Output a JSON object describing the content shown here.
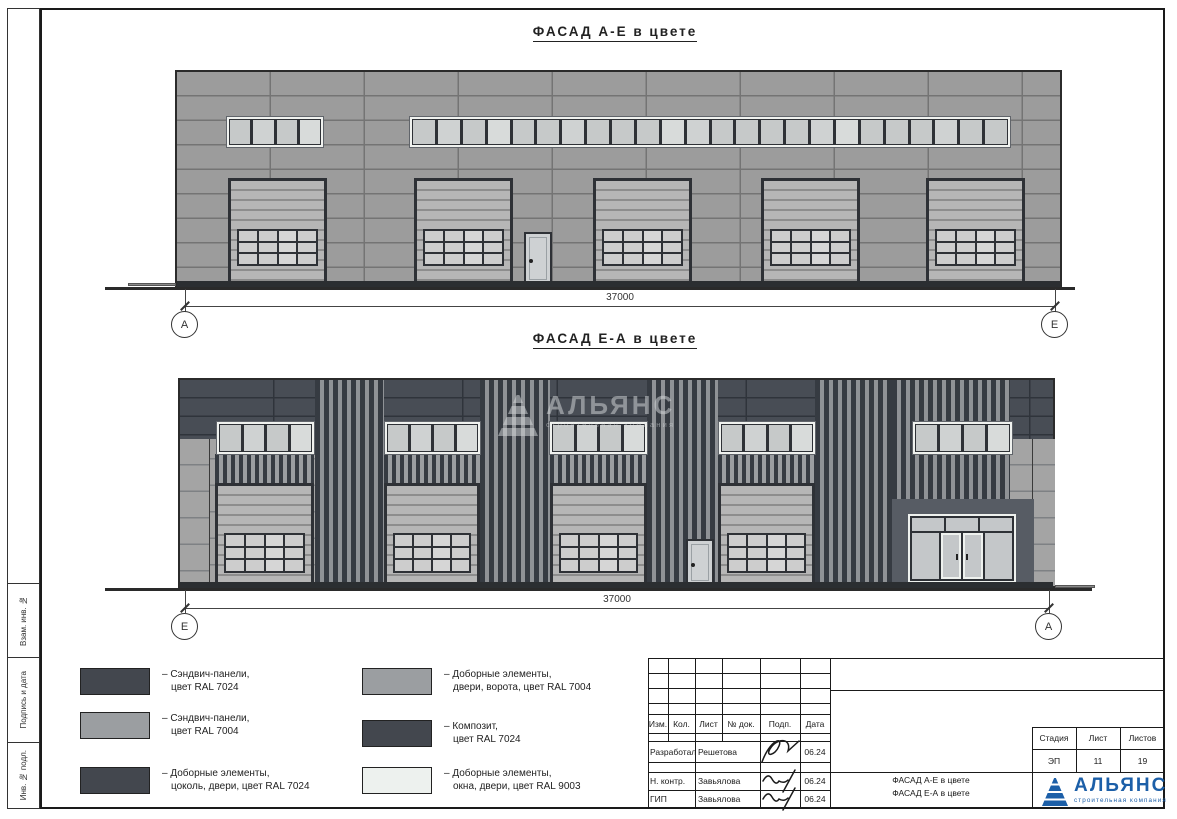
{
  "colors": {
    "ral7024": "#43474e",
    "ral7004": "#9b9ea1",
    "ral9003": "#edf1ee",
    "wall_f1": "#9c9c9c",
    "joint_f1": "#747474",
    "wall_f2": "#a4a4a4",
    "band_dark": "#484d55",
    "band_joint": "#2f343b",
    "slat_dark": "#363b42",
    "slat_gap": "#8f9296",
    "gate_fill": "#b6b6b6",
    "gate_line": "#8d8d8d",
    "gate_pane": "#cdcdcd",
    "win_pane": "#c6c9c9",
    "frame_dark": "#2e3136",
    "door_fill": "#ced1d3",
    "entrance": "#575c64",
    "logo_blue": "#1c5fa8"
  },
  "facade1": {
    "title": "ФАСАД А-Е в цвете",
    "dimension": "37000",
    "axis_left": "А",
    "axis_right": "Е"
  },
  "facade2": {
    "title": "ФАСАД Е-А в цвете",
    "dimension": "37000",
    "axis_left": "Е",
    "axis_right": "А"
  },
  "legend": [
    {
      "swatch": "ral7024",
      "line1": "– Сэндвич-панели,",
      "line2": "цвет RAL 7024"
    },
    {
      "swatch": "ral7004",
      "line1": "– Сэндвич-панели,",
      "line2": "цвет RAL 7004"
    },
    {
      "swatch": "ral7024",
      "line1": "– Доборные элементы,",
      "line2": "цоколь, двери, цвет RAL 7024"
    },
    {
      "swatch": "ral7004",
      "line1": "– Доборные элементы,",
      "line2": "двери, ворота, цвет RAL 7004"
    },
    {
      "swatch": "ral7024",
      "line1": "– Композит,",
      "line2": "цвет RAL 7024"
    },
    {
      "swatch": "ral9003",
      "line1": "– Доборные элементы,",
      "line2": "окна, двери, цвет RAL 9003"
    }
  ],
  "titleblock": {
    "columns": [
      "Изм.",
      "Кол.",
      "Лист",
      "№ док.",
      "Подп.",
      "Дата"
    ],
    "staff": [
      {
        "role": "Разработал",
        "name": "Решетова",
        "date": "06.24"
      },
      {
        "role": "Н. контр.",
        "name": "Завьялова",
        "date": "06.24"
      },
      {
        "role": "ГИП",
        "name": "Завьялова",
        "date": "06.24"
      }
    ],
    "doc_line1": "ФАСАД А-Е в цвете",
    "doc_line2": "ФАСАД Е-А в цвете",
    "stage_label": "Стадия",
    "sheet_label": "Лист",
    "sheets_label": "Листов",
    "stage": "ЭП",
    "sheet_no": "11",
    "sheets_total": "19"
  },
  "sidebar": {
    "label1": "Взам. инв. №",
    "label2": "Подпись и дата",
    "label3": "Инв. № подл."
  },
  "logo": {
    "name": "АЛЬЯНС",
    "subtitle": "строительная компания"
  },
  "watermark": {
    "name": "АЛЬЯНС",
    "subtitle": "строительная компания"
  }
}
